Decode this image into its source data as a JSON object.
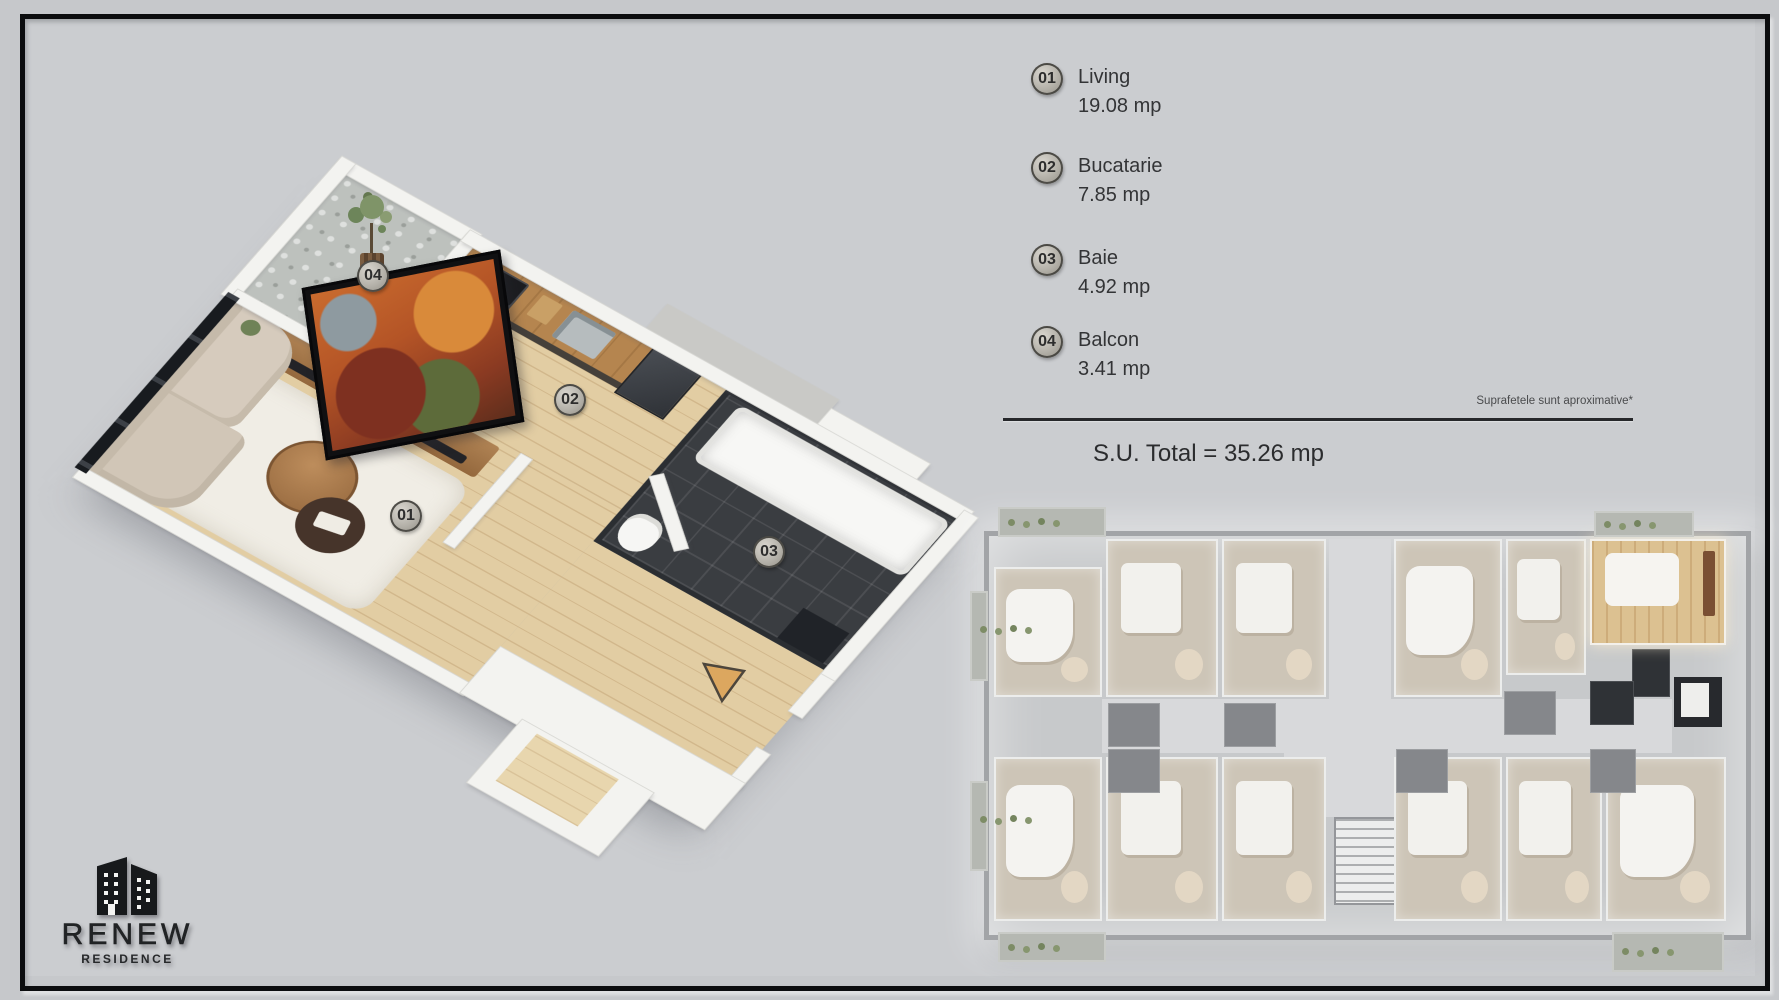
{
  "legend": {
    "items": [
      {
        "num": "01",
        "name": "Living",
        "area": "19.08 mp"
      },
      {
        "num": "02",
        "name": "Bucatarie",
        "area": "7.85 mp"
      },
      {
        "num": "03",
        "name": "Baie",
        "area": "4.92 mp"
      },
      {
        "num": "04",
        "name": "Balcon",
        "area": "3.41 mp"
      }
    ],
    "note": "Suprafetele sunt aproximative*",
    "total": "S.U. Total = 35.26 mp"
  },
  "plan_badges": [
    "01",
    "02",
    "03",
    "04"
  ],
  "logo": {
    "name": "RENEW",
    "tagline": "RESIDENCE"
  },
  "colors": {
    "background": "#c8cacd",
    "frame": "#0c0d0f",
    "wood_floor": "#e2cda3",
    "counter_wood": "#b5854f",
    "bath_tile": "#3a3d41",
    "entry_arrow": "#dca75f",
    "featured_unit": "#dcc191"
  }
}
